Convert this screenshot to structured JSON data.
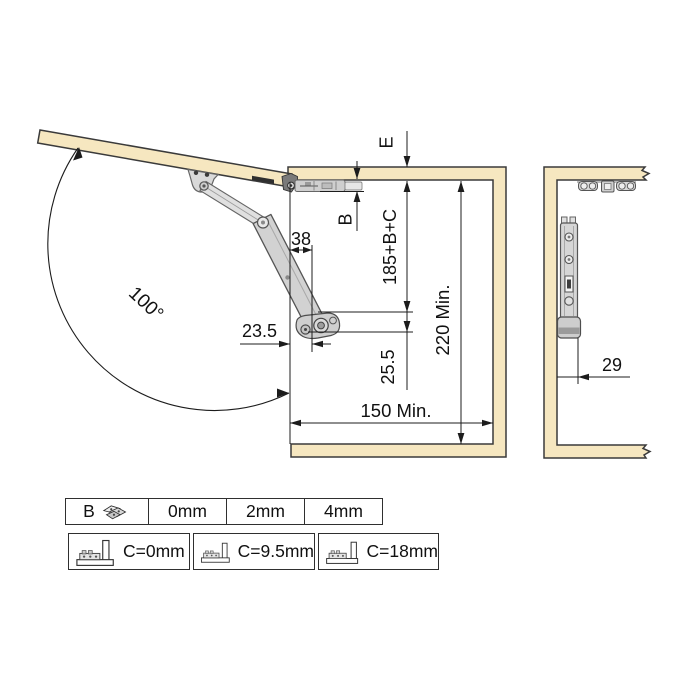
{
  "labels": {
    "angle": "100°",
    "dim38": "38",
    "dim235": "23.5",
    "dimE": "E",
    "dimB": "B",
    "dim185": "185+B+C",
    "dim255": "25.5",
    "dim220": "220 Min.",
    "dim150": "150 Min.",
    "dim29": "29"
  },
  "table": {
    "row_b": {
      "header": "B",
      "values": [
        "0mm",
        "2mm",
        "4mm"
      ]
    },
    "row_c": {
      "options": [
        "C=0mm",
        "C=9.5mm",
        "C=18mm"
      ]
    }
  },
  "colors": {
    "panel": "#f6e7c0",
    "outline": "#3a3a3a",
    "mechanism": "#d2d2d2",
    "dimension": "#1c1c1c"
  }
}
